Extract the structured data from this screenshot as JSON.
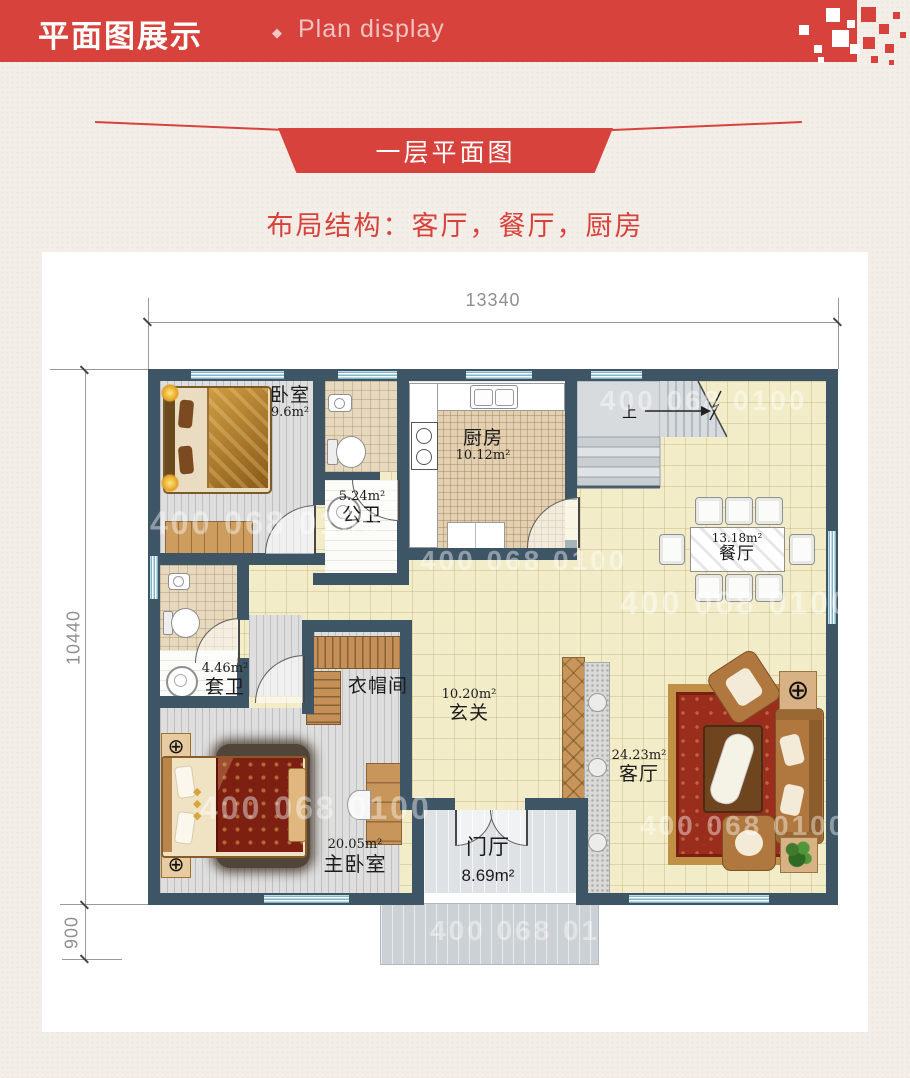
{
  "header": {
    "title_zh": "平面图展示",
    "divider": "◆",
    "title_en": "Plan display"
  },
  "ribbon": {
    "label": "一层平面图"
  },
  "subtitle": "布局结构：客厅，餐厅，厨房",
  "dimensions": {
    "width_total": "13340",
    "height_total": "10440",
    "porch_depth": "900"
  },
  "stairs": {
    "up_label": "上"
  },
  "watermark": {
    "phone": "400 068 0100"
  },
  "rooms": {
    "bedroom": {
      "name": "卧室",
      "area": "9.6m²"
    },
    "public_bath": {
      "name": "公卫",
      "area": "5.24m²"
    },
    "kitchen": {
      "name": "厨房",
      "area": "10.12m²"
    },
    "dining": {
      "name": "餐厅",
      "area": "13.18m²"
    },
    "ensuite_bath": {
      "name": "套卫",
      "area": "4.46m²"
    },
    "cloakroom": {
      "name": "衣帽间"
    },
    "entry_hall": {
      "name": "玄关",
      "area": "10.20m²"
    },
    "living": {
      "name": "客厅",
      "area": "24.23m²"
    },
    "master_bedroom": {
      "name": "主卧室",
      "area": "20.05m²"
    },
    "foyer": {
      "name": "门厅",
      "area": "8.69m²"
    }
  },
  "colors": {
    "accent_red": "#d8423d",
    "wall": "#3e5565",
    "floor_cream": "#f2ecc8",
    "floor_tile": "#e7d9bd",
    "window_blue": "#7fb6ca"
  }
}
